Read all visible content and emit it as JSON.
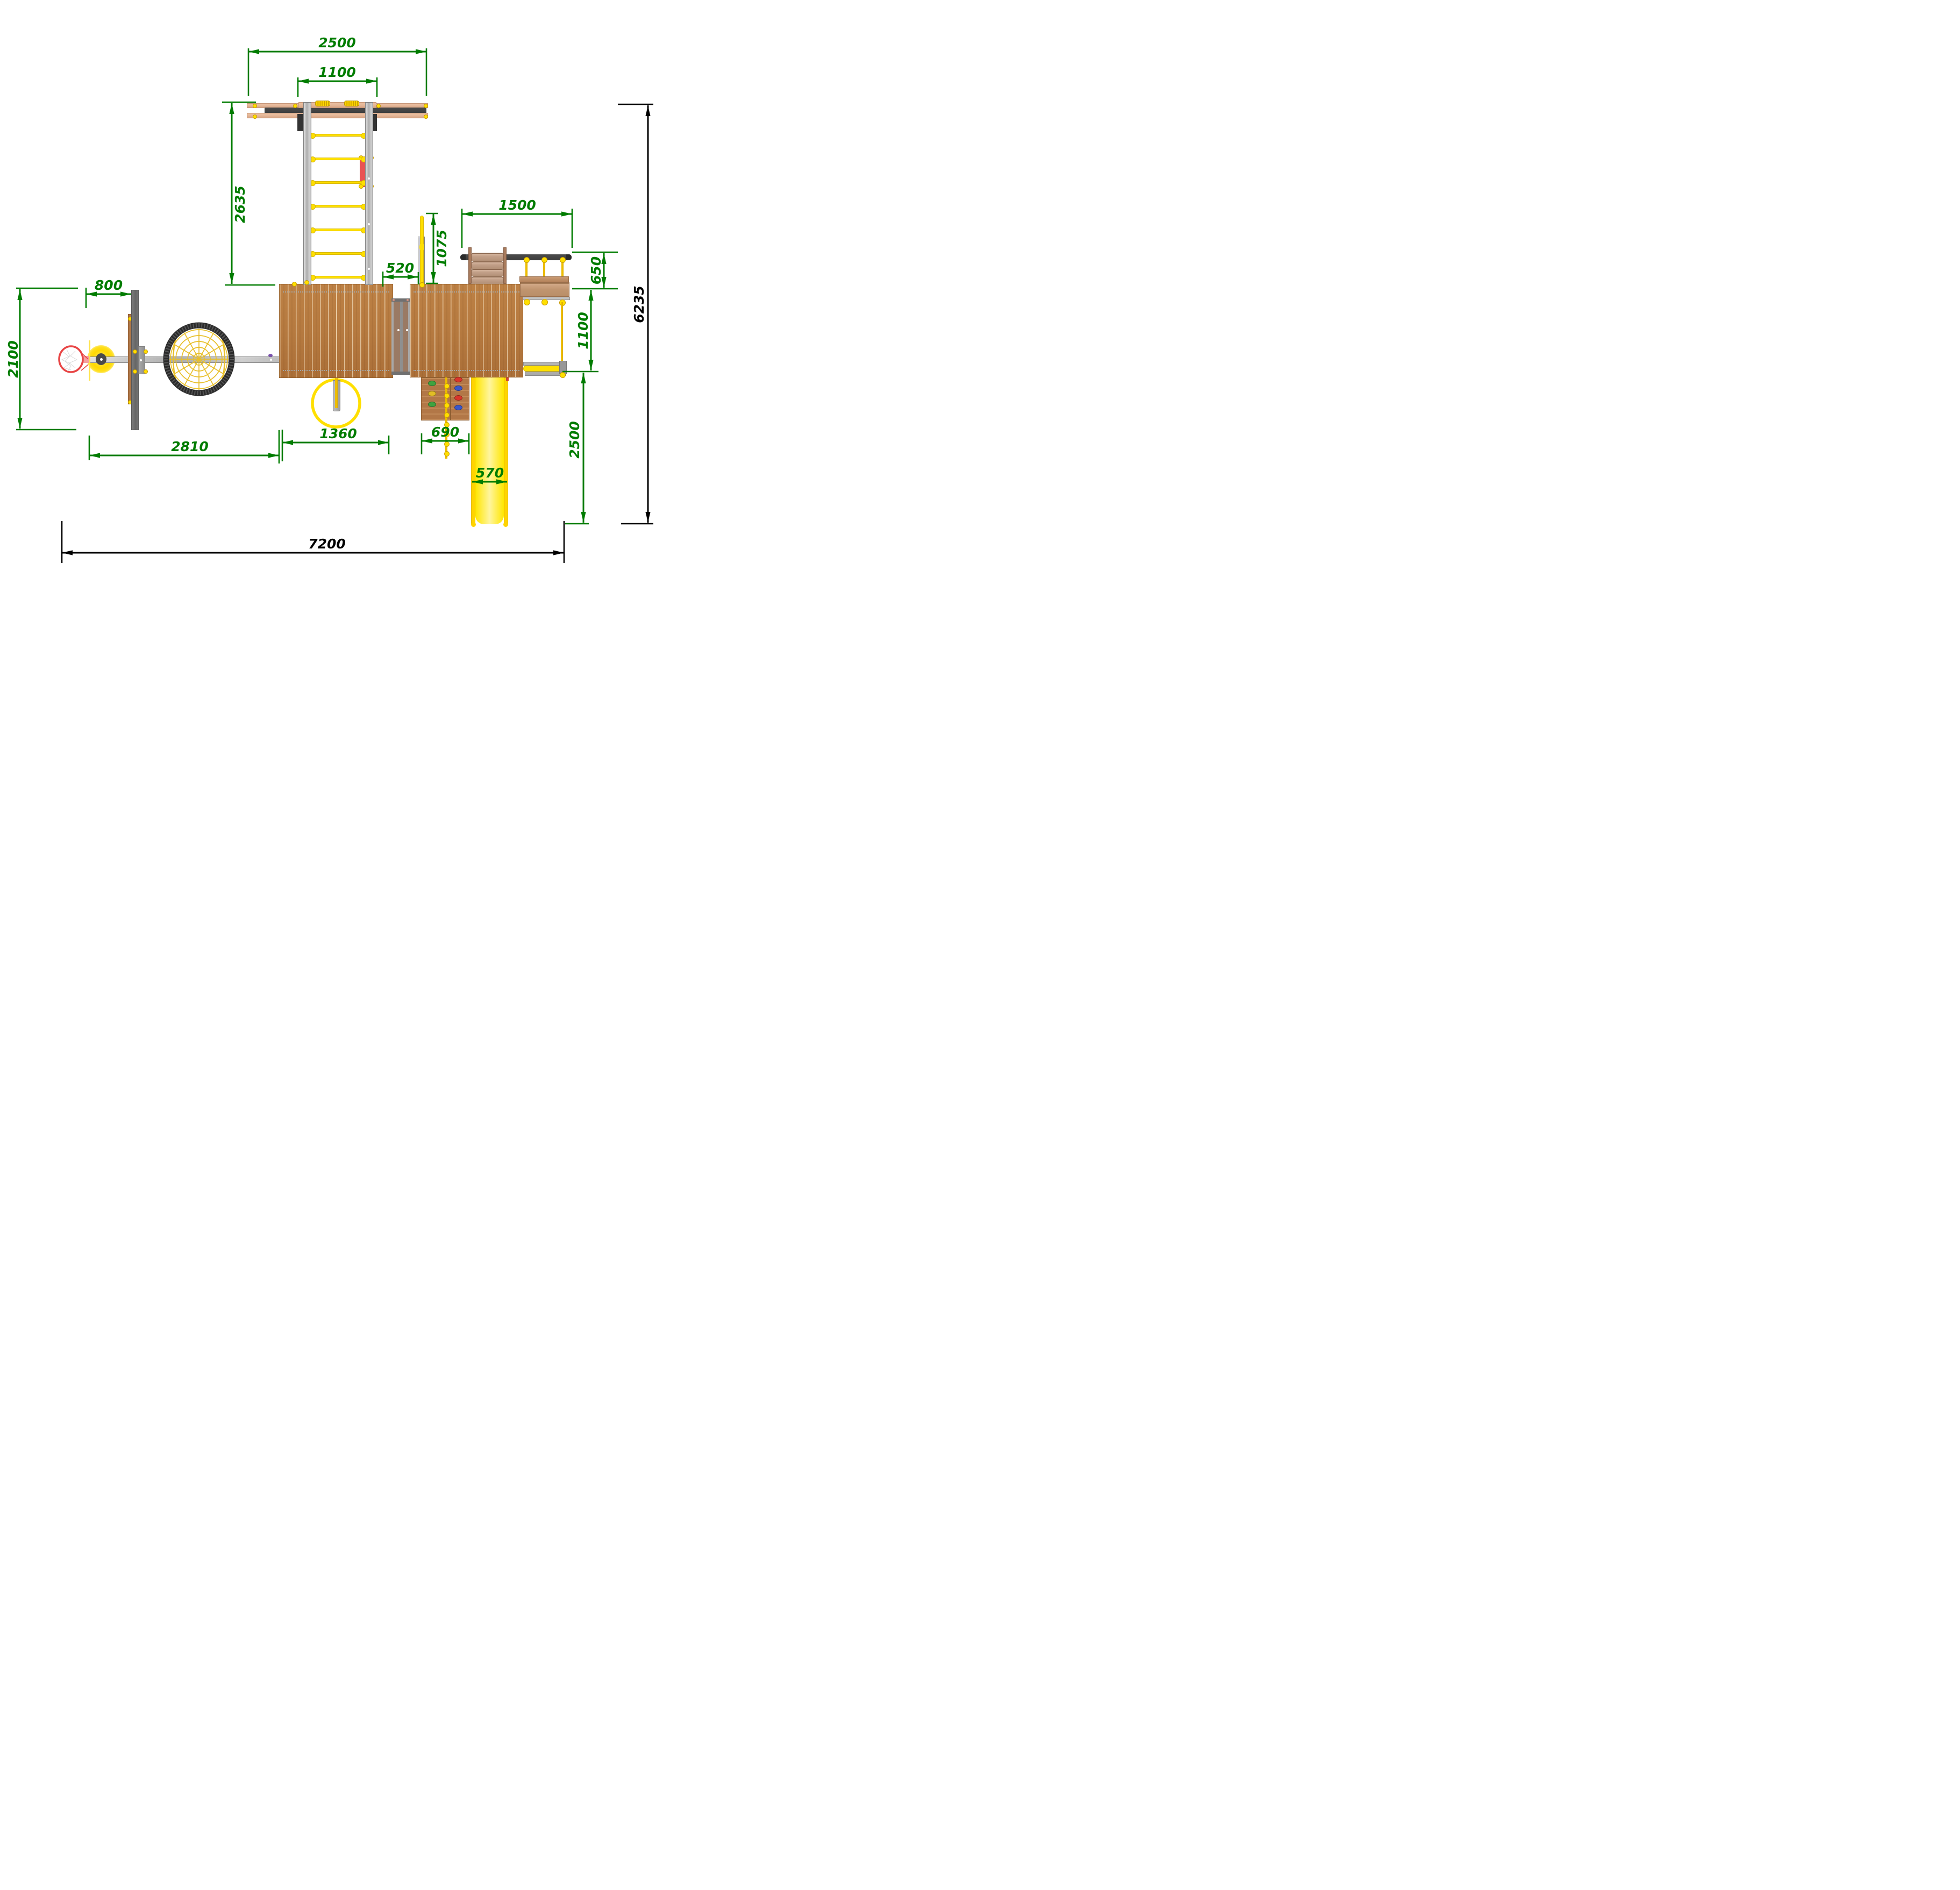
{
  "title": "Playground complex - top view dimensional drawing",
  "units": "mm",
  "dims": {
    "beam_span_top": "2500",
    "swing_hanger_spacing": "1100",
    "ladder_length": "2635",
    "backboard_offset": "800",
    "left_module_depth": "2100",
    "left_module_span": "2810",
    "ring_swing_span": "1360",
    "pole_gap": "520",
    "pole_length": "1075",
    "swing_beam_length": "1500",
    "swing_seat_offset": "650",
    "swing_clearance": "1100",
    "slide_clearance": "2500",
    "climb_wall_width": "690",
    "slide_width": "570",
    "total_width": "7200",
    "total_depth": "6235"
  },
  "colors": {
    "dim_green": "#007c00",
    "dim_black": "#000000",
    "deck_wood": "#b5793f",
    "deck_wood_dark": "#a06633",
    "deck_gap": "#d8ad79",
    "beam_wood": "#e3b495",
    "beam_dark": "#3d3d3d",
    "steel_light": "#d6d6d6",
    "steel_mid": "#a9a9a9",
    "steel_dark": "#6f6f6f",
    "rope_yellow": "#f2c200",
    "bright_yellow": "#ffdf00",
    "slide_yellow": "#ffe600",
    "panel_red": "#e63c3c",
    "ring_red": "#e84545",
    "ball_yellow": "#ffd900",
    "hold_green": "#3fa33f",
    "hold_yellow": "#e2bd25",
    "hold_red": "#d9362b",
    "hold_blue": "#3a57c9",
    "nest_ring": "#2b2b2b",
    "net_yellow": "#e8bf2a",
    "bridge_gray": "#a0a0a0",
    "bridge_brown": "#9a7a64",
    "ramp_wood": "#c2a089",
    "ramp_rail": "#a87a5c",
    "seat_wood": "#c09570"
  }
}
